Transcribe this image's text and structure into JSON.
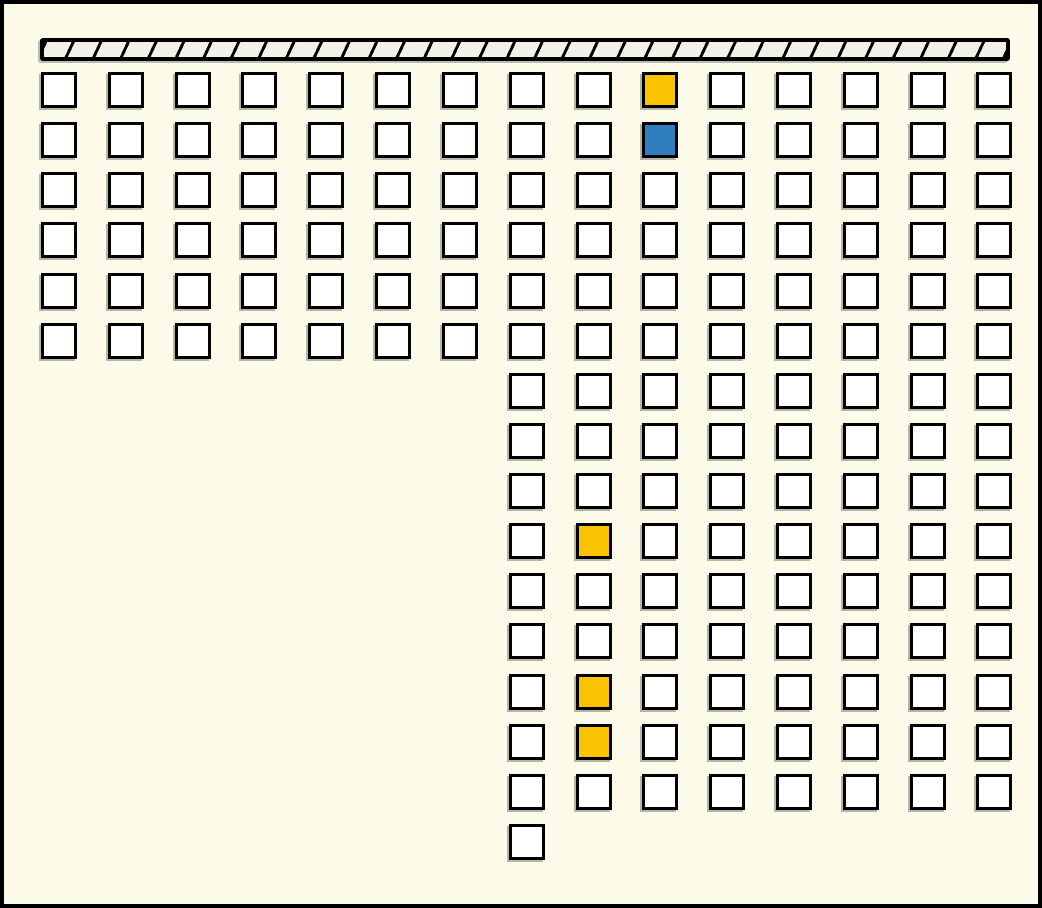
{
  "canvas": {
    "background": "#FCFBEA",
    "border_color": "#000000",
    "width": 1042,
    "height": 908
  },
  "wall_bar": {
    "x": 36,
    "y": 34,
    "width": 970,
    "height": 23,
    "fill": "#F2F1E7",
    "hatch_color": "#000000",
    "hatch_stroke_px": 3,
    "hatch_pitch_px": 25
  },
  "grid": {
    "square_size": 36,
    "square_fill": "#FFFFFF",
    "square_border_color": "#000000",
    "col_start_x": 37,
    "col_pitch": 66.82,
    "row_start_y": 68,
    "row_pitch": 50.13,
    "total_squares": 163,
    "rows": [
      {
        "row": 1,
        "from_col": 1,
        "to_col": 15
      },
      {
        "row": 2,
        "from_col": 1,
        "to_col": 15
      },
      {
        "row": 3,
        "from_col": 1,
        "to_col": 15
      },
      {
        "row": 4,
        "from_col": 1,
        "to_col": 15
      },
      {
        "row": 5,
        "from_col": 1,
        "to_col": 15
      },
      {
        "row": 6,
        "from_col": 1,
        "to_col": 15
      },
      {
        "row": 7,
        "from_col": 8,
        "to_col": 15
      },
      {
        "row": 8,
        "from_col": 8,
        "to_col": 15
      },
      {
        "row": 9,
        "from_col": 8,
        "to_col": 15
      },
      {
        "row": 10,
        "from_col": 8,
        "to_col": 15
      },
      {
        "row": 11,
        "from_col": 8,
        "to_col": 15
      },
      {
        "row": 12,
        "from_col": 8,
        "to_col": 15
      },
      {
        "row": 13,
        "from_col": 8,
        "to_col": 15
      },
      {
        "row": 14,
        "from_col": 8,
        "to_col": 15
      },
      {
        "row": 15,
        "from_col": 8,
        "to_col": 15
      },
      {
        "row": 16,
        "from_col": 8,
        "to_col": 8
      }
    ],
    "highlighted_cells": [
      {
        "row": 1,
        "col": 10,
        "color": "#F8C402",
        "name": "yellow"
      },
      {
        "row": 2,
        "col": 10,
        "color": "#2F7FC0",
        "name": "blue"
      },
      {
        "row": 10,
        "col": 9,
        "color": "#F8C402",
        "name": "yellow"
      },
      {
        "row": 13,
        "col": 9,
        "color": "#F8C402",
        "name": "yellow"
      },
      {
        "row": 14,
        "col": 9,
        "color": "#F8C402",
        "name": "yellow"
      }
    ],
    "highlight_colors": {
      "yellow": "#F8C402",
      "blue": "#2F7FC0"
    }
  }
}
